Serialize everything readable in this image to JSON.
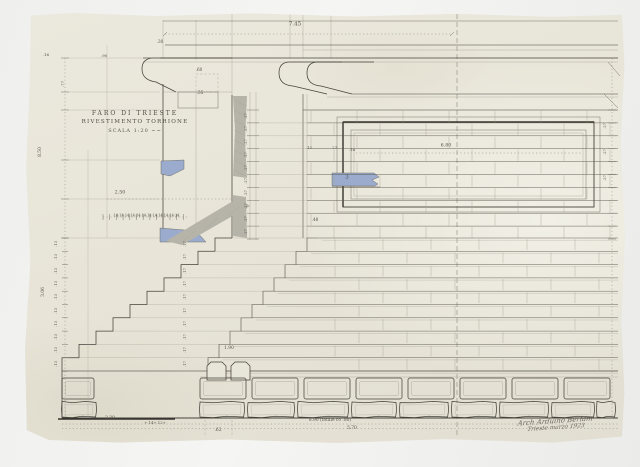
{
  "title_block": {
    "line1": "FARO DI TRIESTE",
    "line2": "RIVESTIMENTO TORRIONE",
    "line3": "SCALA 1:20 ~~"
  },
  "signature": {
    "line1": "Arch Arduino Berlam",
    "line2": "Trieste marzo 1923"
  },
  "labels": [
    {
      "t": "7.45",
      "x": 295,
      "y": 25,
      "s": 5.5
    },
    {
      "t": ".30",
      "x": 160,
      "y": 42,
      "s": 4.2
    },
    {
      "t": ".60",
      "x": 199,
      "y": 70,
      "s": 4.2
    },
    {
      "t": ".55",
      "x": 200,
      "y": 93,
      "s": 4.2
    },
    {
      "t": ".16",
      "x": 46,
      "y": 55,
      "s": 4
    },
    {
      "t": ".90",
      "x": 104,
      "y": 56,
      "s": 4
    },
    {
      "t": ".77",
      "x": 63,
      "y": 84,
      "s": 4,
      "r": -90
    },
    {
      "t": "8.50",
      "x": 41,
      "y": 152,
      "s": 4.4,
      "r": -90
    },
    {
      "t": "3.06",
      "x": 44,
      "y": 292,
      "s": 4.4,
      "r": -90
    },
    {
      "t": "2.50",
      "x": 120,
      "y": 194,
      "s": 4.8
    },
    {
      "t": "·14·14·14·14·14·14·14·14·14·14·14·14",
      "x": 146,
      "y": 216,
      "s": 3.5
    },
    {
      "t": ".12",
      "x": 309,
      "y": 148,
      "s": 4
    },
    {
      "t": ".27",
      "x": 334,
      "y": 148,
      "s": 4
    },
    {
      "t": ".16",
      "x": 352,
      "y": 150,
      "s": 4
    },
    {
      "t": "6.80",
      "x": 446,
      "y": 147,
      "s": 4.8
    },
    {
      "t": "3",
      "x": 347,
      "y": 178,
      "s": 5.5
    },
    {
      "t": ".48",
      "x": 315,
      "y": 220,
      "s": 4.2
    },
    {
      "t": "1.90",
      "x": 229,
      "y": 349,
      "s": 4.4
    },
    {
      "t": "2.30",
      "x": 110,
      "y": 419,
      "s": 4.4
    },
    {
      "t": "+.14+.12+",
      "x": 155,
      "y": 423,
      "s": 3.8
    },
    {
      "t": ".62",
      "x": 218,
      "y": 431,
      "s": 4.4
    },
    {
      "t": "8.90 (totale co .80)",
      "x": 330,
      "y": 421,
      "s": 4.4
    },
    {
      "t": "5.70",
      "x": 352,
      "y": 429,
      "s": 4.4
    }
  ],
  "dim_chains": [
    {
      "t": ".27",
      "x": 247,
      "y0": 116,
      "dy": 12.9,
      "n": 10,
      "r": -90,
      "s": 3.6
    },
    {
      "t": ".13",
      "x": 57,
      "y0": 244,
      "dy": 13.3,
      "n": 10,
      "r": -90,
      "s": 3.6
    },
    {
      "t": ".17",
      "x": 186,
      "y0": 244,
      "dy": 13.3,
      "n": 10,
      "r": -90,
      "s": 3.6
    },
    {
      "t": ".27",
      "x": 606,
      "y0": 126,
      "dy": 26,
      "n": 3,
      "r": -90,
      "s": 3.6
    }
  ],
  "colors": {
    "paper": "#e8e5d9",
    "background": "#f3f3f1",
    "ink": "#45433a",
    "pencil": "#a5a295",
    "blue_wash": "#9aabcd",
    "gray_wash": "#b6b4a9"
  }
}
